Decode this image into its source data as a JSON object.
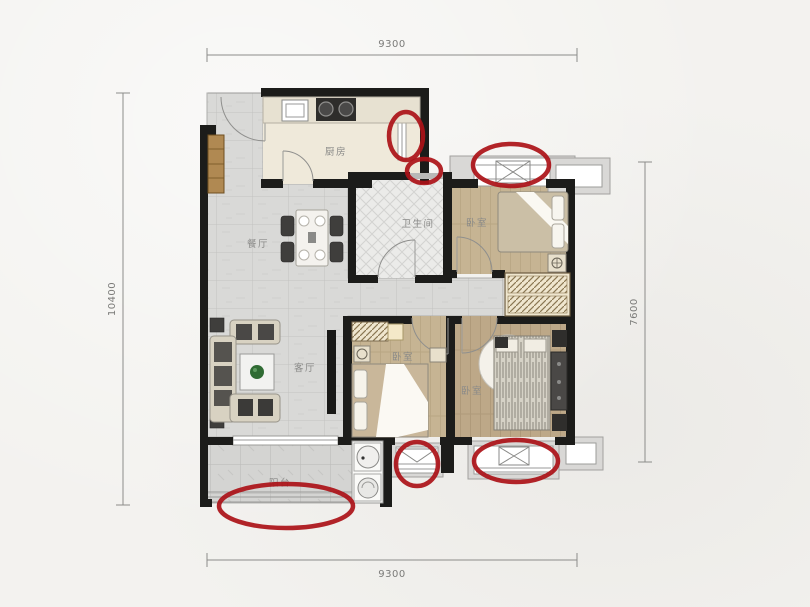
{
  "plan_title": "apartment-floor-plan",
  "dimensions": {
    "top": "9300",
    "bottom": "9300",
    "left": "10400",
    "right": "7600"
  },
  "rooms": {
    "kitchen": {
      "label": "厨房"
    },
    "dining": {
      "label": "餐厅"
    },
    "bathroom": {
      "label": "卫生间"
    },
    "bedroom_top": {
      "label": "卧室"
    },
    "living": {
      "label": "客厅"
    },
    "bedroom_middle": {
      "label": "卧室"
    },
    "bedroom_master": {
      "label": "卧室"
    },
    "balcony": {
      "label": "阳台"
    }
  },
  "annotations": {
    "color": "#ab1117",
    "stroke_width": 4.5,
    "marks": "red ellipses circling window / vent locations",
    "ellipses": [
      {
        "cx": 406,
        "cy": 136,
        "rx": 17,
        "ry": 24
      },
      {
        "cx": 424,
        "cy": 171,
        "rx": 17,
        "ry": 12
      },
      {
        "cx": 511,
        "cy": 165,
        "rx": 38,
        "ry": 21
      },
      {
        "cx": 417,
        "cy": 464,
        "rx": 21,
        "ry": 22
      },
      {
        "cx": 516,
        "cy": 461,
        "rx": 42,
        "ry": 21
      },
      {
        "cx": 286,
        "cy": 506,
        "rx": 67,
        "ry": 22
      }
    ]
  },
  "colors": {
    "background": "#f3f2ef",
    "wall": "#1c1c1a",
    "tile_floor": "#d9d9d7",
    "wood_floor": "#c4b292",
    "kitchen_floor": "#efe9da",
    "balcony_floor": "#d6d6d4",
    "annotation_red": "#ab1117"
  }
}
